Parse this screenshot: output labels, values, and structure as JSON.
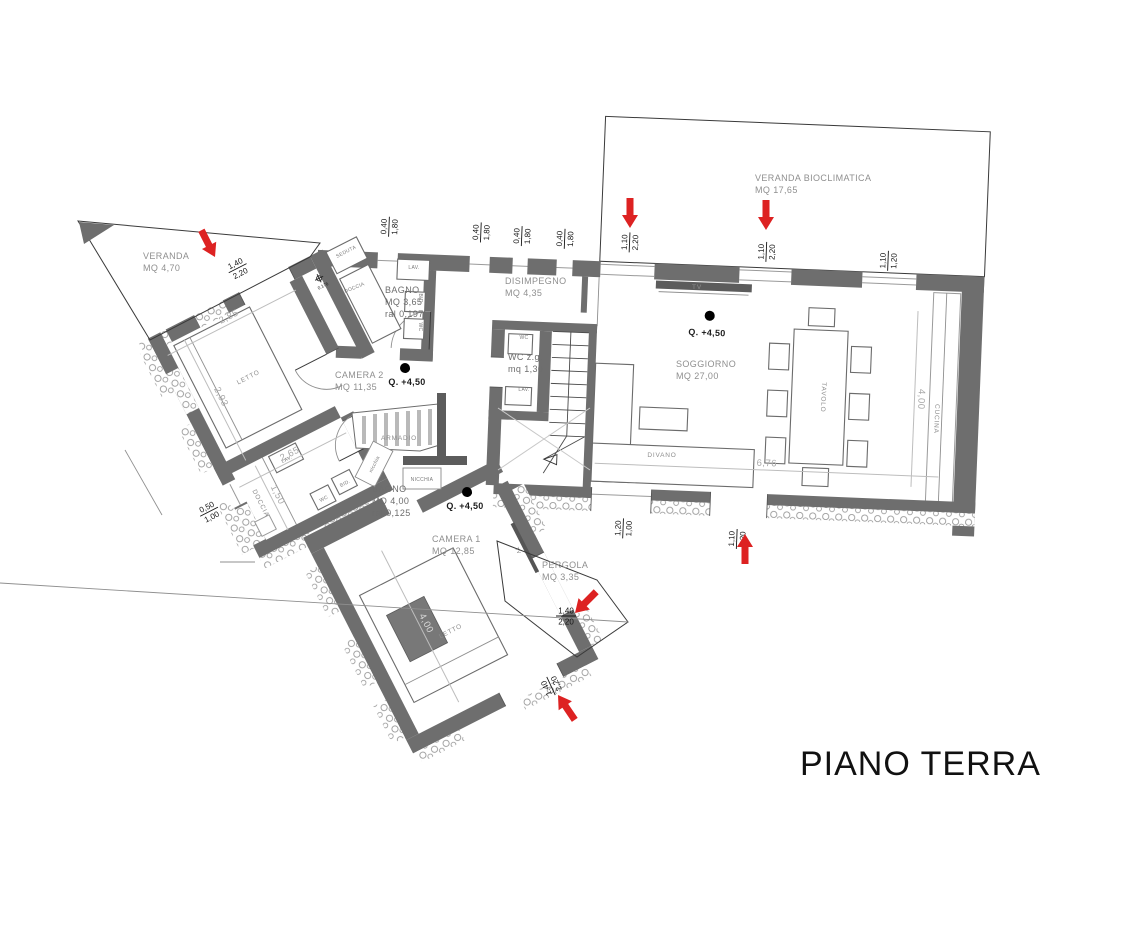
{
  "title": "PIANO TERRA",
  "rooms": {
    "veranda_bioclimatica": {
      "name": "VERANDA BIOCLIMATICA",
      "area": "MQ 17,65"
    },
    "veranda": {
      "name": "VERANDA",
      "area": "MQ 4,70"
    },
    "bagno1": {
      "name": "BAGNO",
      "area": "MQ 3,65",
      "note": "ral 0,197"
    },
    "disimpegno": {
      "name": "DISIMPEGNO",
      "area": "MQ 4,35"
    },
    "camera2": {
      "name": "CAMERA 2",
      "area": "MQ 11,35"
    },
    "wc_zg": {
      "name": "WC z.g.",
      "area": "mq 1,30"
    },
    "soggiorno": {
      "name": "SOGGIORNO",
      "area": "MQ 27,00"
    },
    "bagno2": {
      "name": "BAGNO",
      "area": "MQ 4,00",
      "note": "ral 0,125"
    },
    "camera1": {
      "name": "CAMERA 1",
      "area": "MQ 12,85"
    },
    "pergola": {
      "name": "PERGOLA",
      "area": "MQ 3,35"
    }
  },
  "furniture": {
    "tv": "TV",
    "tavolo": "TAVOLO",
    "cucina": "CUCINA",
    "divano": "DIVANO",
    "letto": "LETTO",
    "armadio": "ARMADIO",
    "nicchia": "NICCHIA",
    "nicchia_small": "nicchia",
    "seduta": "SEDUTA",
    "doccia": "DOCCIA",
    "lav": "LAV.",
    "wc": "WC",
    "bid": "BID."
  },
  "levels": {
    "q": "Q. +4,50",
    "seduta_mark": "0.176"
  },
  "dims": {
    "w040_180": {
      "a": "0,40",
      "b": "1,80"
    },
    "w110_220": {
      "a": "1,10",
      "b": "2,20"
    },
    "w110_120": {
      "a": "1,10",
      "b": "1,20"
    },
    "w120_100": {
      "a": "1,20",
      "b": "1,00"
    },
    "w050_100": {
      "a": "0,50",
      "b": "1,00"
    },
    "w140_220": {
      "a": "1,40",
      "b": "2,20"
    },
    "l285": "2,85",
    "l293": "2,93",
    "l265": "2,65",
    "l150": "1,50",
    "l400": "4,00",
    "l676": "6,76",
    "l400c": "4,00"
  },
  "colors": {
    "wall": "#6e6e6e",
    "red_arrow": "#dd2222",
    "dim_text": "#161616",
    "light_text": "#8f8f8f"
  }
}
